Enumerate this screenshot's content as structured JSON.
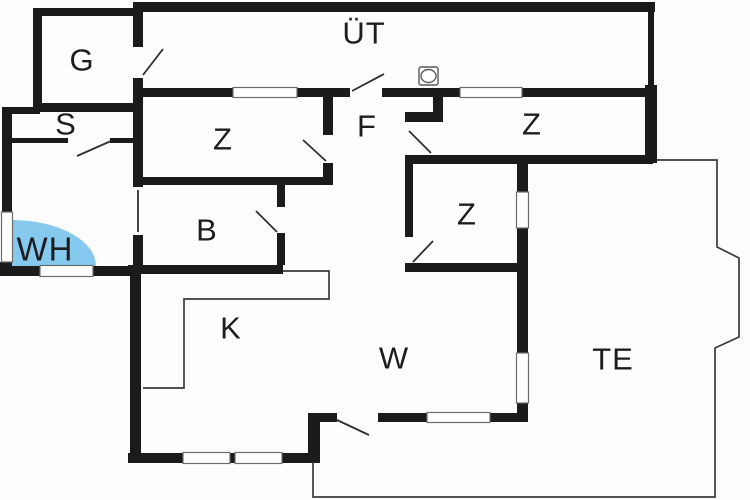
{
  "plan_title": "apartment-floor-plan",
  "colors": {
    "wall": "#1b1b1b",
    "thin_line": "#3a3a3a",
    "highlight_blue": "#85c9ee",
    "background": "#fdfdfd",
    "label_text": "#1d1d1d"
  },
  "rooms": {
    "ut": {
      "label": "ÜT"
    },
    "g": {
      "label": "G"
    },
    "s": {
      "label": "S"
    },
    "wh": {
      "label": "WH"
    },
    "z_left": {
      "label": "Z"
    },
    "f": {
      "label": "F"
    },
    "z_top_right": {
      "label": "Z"
    },
    "z_middle": {
      "label": "Z"
    },
    "b": {
      "label": "B"
    },
    "k": {
      "label": "K"
    },
    "w": {
      "label": "W"
    },
    "te": {
      "label": "TE"
    }
  },
  "icons": {
    "washer": "washer-icon"
  }
}
